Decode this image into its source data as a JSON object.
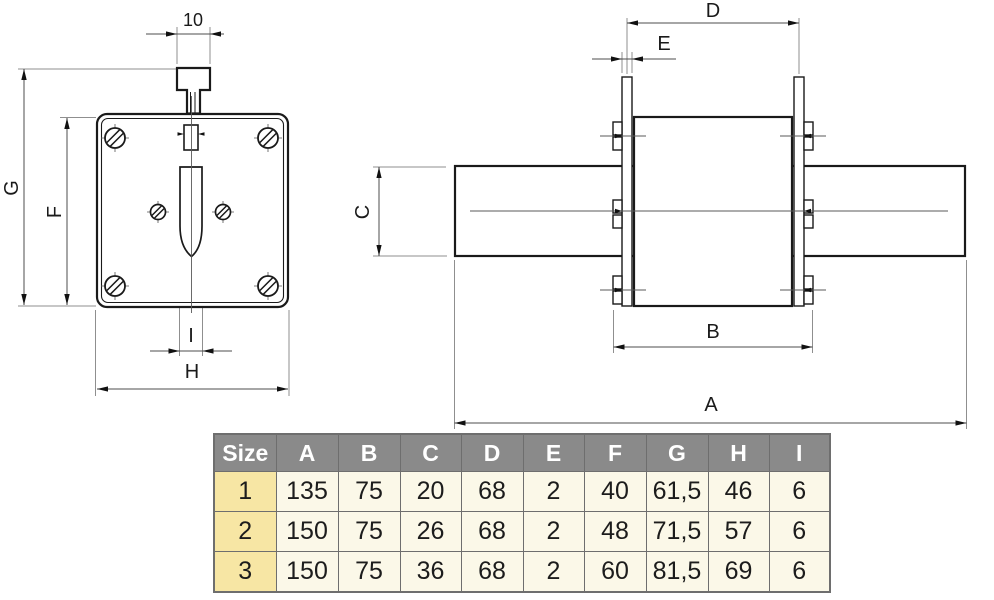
{
  "drawing": {
    "front_view": {
      "dim_top": "10",
      "dim_total_height": "G",
      "dim_plate_height": "F",
      "dim_blade_width": "I",
      "dim_plate_width": "H"
    },
    "side_view": {
      "dim_tab_span": "D",
      "dim_tab_thickness": "E",
      "dim_blade_height": "C",
      "dim_body_width": "B",
      "dim_total_length": "A"
    }
  },
  "table": {
    "headers": [
      "Size",
      "A",
      "B",
      "C",
      "D",
      "E",
      "F",
      "G",
      "H",
      "I"
    ],
    "rows": [
      {
        "size": "1",
        "values": [
          "135",
          "75",
          "20",
          "68",
          "2",
          "40",
          "61,5",
          "46",
          "6"
        ]
      },
      {
        "size": "2",
        "values": [
          "150",
          "75",
          "26",
          "68",
          "2",
          "48",
          "71,5",
          "57",
          "6"
        ]
      },
      {
        "size": "3",
        "values": [
          "150",
          "75",
          "36",
          "68",
          "2",
          "60",
          "81,5",
          "69",
          "6"
        ]
      }
    ]
  },
  "colors": {
    "header_bg": "#8a8a8a",
    "header_text": "#ffffff",
    "size_col_bg": "#f7e6a4",
    "cell_bg": "#fbf8e8",
    "grid_border": "#6e6e6e",
    "outline": "#1a1a1a",
    "dim_line": "#4d4d4d",
    "ext_line": "#8f8f8f"
  }
}
